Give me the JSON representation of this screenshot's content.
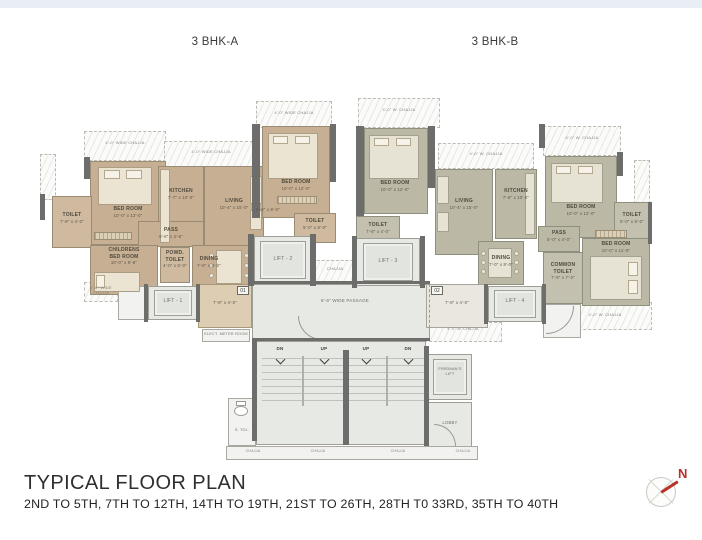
{
  "header": {
    "unit_a_title": "3 BHK-A",
    "unit_b_title": "3 BHK-B"
  },
  "footer": {
    "title": "TYPICAL FLOOR PLAN",
    "floors": "2ND TO 5TH, 7TH TO 12TH, 14TH TO 19TH, 21ST TO 26TH, 28TH T0 33RD, 35TH TO 40TH",
    "north": "N"
  },
  "core": {
    "passage": "8'-6\" WIDE PASSAGE",
    "chajja": "CHAJJA",
    "up": "UP",
    "dn": "DN",
    "servant_toilet": "S. TOL.",
    "fireman_lift": "FIREMAN'S\nLIFT",
    "lobby": "LOBBY",
    "meter_room": "ELECT. METER ROOM"
  },
  "unit_a": {
    "unit_no": "01",
    "entrance_dims": "7'-8\" x 4'-0\"",
    "lift1": "LIFT - 1",
    "lift2": "LIFT - 2",
    "chajja_top_left": "4'-0\" WIDE CHAJJA",
    "chajja_top_mid": "4'-0\" WIDE CHAJJA",
    "chajja_top_right": "4'-0\" WIDE CHAJJA",
    "chajja_bottom_left": "2'-6\" WIDE\nCHAJJA",
    "bed_master": {
      "name": "BED ROOM",
      "dims": "10'-0\" x 12'-0\""
    },
    "toilet_left": {
      "name": "TOILET",
      "dims": "7'-8\" x 4'-0\""
    },
    "kitchen": {
      "name": "KITCHEN",
      "dims": "7'-7\" x 10'-0\""
    },
    "living": {
      "name": "LIVING",
      "dims": "10'-4\" x 15'-0\""
    },
    "bed_second": {
      "name": "BED ROOM",
      "dims": "10'-0\" x 12'-0\""
    },
    "toilet_attached": {
      "name": "TOILET",
      "dims": "5'-0\" x 8'-0\""
    },
    "dress_dims": "4'-0\" x 8'-0\"",
    "pass": {
      "name": "PASS",
      "dims": "9'-8\" x 3'-6\""
    },
    "children_bed": {
      "name": "CHILDRENS\nBED ROOM",
      "dims": "10'-0\" x 9'-8\""
    },
    "powder_toilet": {
      "name": "POWD.\nTOILET",
      "dims": "4'-0\" x 5'-0\""
    },
    "dining": {
      "name": "DINING",
      "dims": "7'-6\" x 8'-0\""
    }
  },
  "unit_b": {
    "unit_no": "02",
    "entrance_dims": "7'-8\" x 4'-0\"",
    "lift3": "LIFT - 3",
    "lift4": "LIFT - 4",
    "chajja_top_left": "4'-0\" W. CHAJJA",
    "chajja_top_mid": "4'-0\" W. CHAJJA",
    "chajja_top_right": "4'-0\" W. CHAJJA",
    "chajja_lobby": "4'-0\" W. CHAJJA",
    "chajja_bottom_right": "4'-0\" W. CHAJJA",
    "bed_first": {
      "name": "BED ROOM",
      "dims": "10'-0\" x 12'-0\""
    },
    "toilet_left": {
      "name": "TOILET",
      "dims": "7'-8\" x 4'-0\""
    },
    "living": {
      "name": "LIVING",
      "dims": "10'-4\" x 15'-0\""
    },
    "kitchen": {
      "name": "KITCHEN",
      "dims": "7'-6\" x 10'-0\""
    },
    "bed_second": {
      "name": "BED ROOM",
      "dims": "10'-0\" x 12'-0\""
    },
    "toilet_right": {
      "name": "TOILET",
      "dims": "5'-0\" x 8'-0\""
    },
    "pass": {
      "name": "PASS",
      "dims": "5'-0\" x 4'-0\""
    },
    "bed_third": {
      "name": "BED ROOM",
      "dims": "10'-0\" x 11'-0\""
    },
    "common_toilet": {
      "name": "COMMON\nTOILET",
      "dims": "7'-8\" x 7'-0\""
    },
    "dining": {
      "name": "DINING",
      "dims": "7'-0\" x 8'-0\""
    }
  },
  "colors": {
    "unit_a_floor": "#c7af93",
    "unit_b_floor": "#bcb8a6",
    "wall": "#6d6d6b",
    "north_red": "#b83227",
    "top_bar": "#e9eef4"
  }
}
